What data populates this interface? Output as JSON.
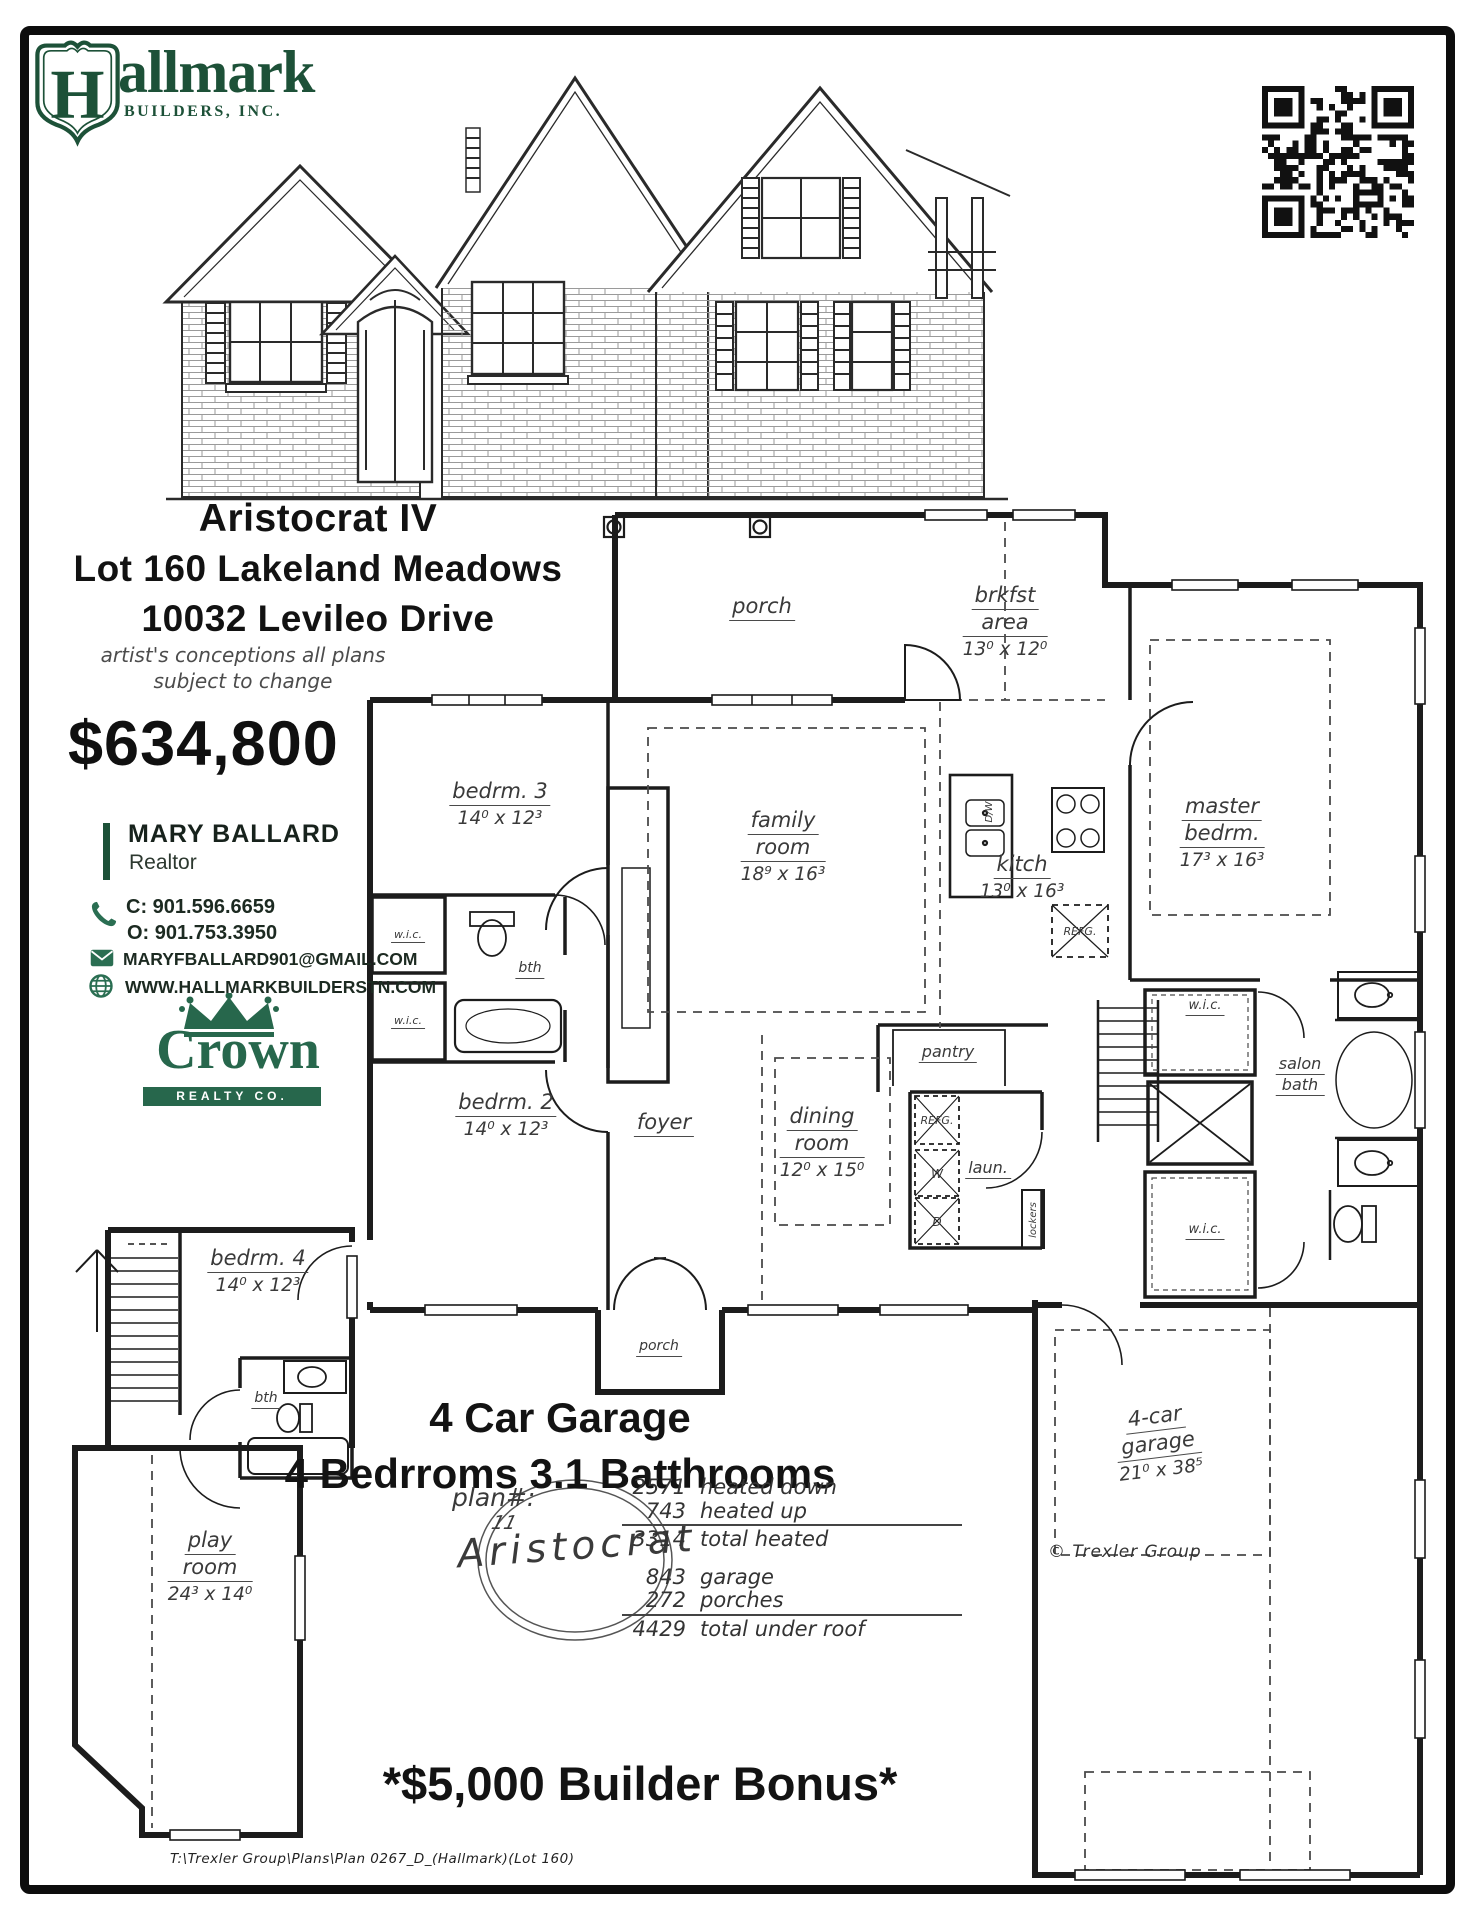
{
  "brand": {
    "hallmark_h": "H",
    "hallmark_rest": "allmark",
    "hallmark_sub": "BUILDERS, INC.",
    "crown_name": "Crown",
    "crown_sub": "REALTY CO.",
    "accent_green": "#1d5138",
    "crown_green": "#27674c"
  },
  "header": {
    "plan_name": "Aristocrat IV",
    "lot_line": "Lot 160 Lakeland Meadows",
    "address_line": "10032 Levileo Drive",
    "disclaimer_line1": "artist's conceptions all plans",
    "disclaimer_line2": "subject to change",
    "price": "$634,800"
  },
  "agent": {
    "name": "MARY BALLARD",
    "title": "Realtor",
    "cell": "C: 901.596.6659",
    "office": "O: 901.753.3950",
    "email": "MARYFBALLARD901@GMAIL.COM",
    "website": "WWW.HALLMARKBUILDERSTN.COM"
  },
  "floorplan": {
    "rooms": {
      "porch_top": {
        "l1": "porch"
      },
      "brkfst": {
        "l1": "brkfst",
        "l2": "area",
        "dims": "13⁰ x 12⁰"
      },
      "bedrm3": {
        "l1": "bedrm. 3",
        "dims": "14⁰ x 12³"
      },
      "family": {
        "l1": "family",
        "l2": "room",
        "dims": "18⁹ x 16³"
      },
      "kitch": {
        "l1": "kitch",
        "dims": "13⁰ x 16³"
      },
      "master": {
        "l1": "master",
        "l2": "bedrm.",
        "dims": "17³ x 16³"
      },
      "bedrm2": {
        "l1": "bedrm. 2",
        "dims": "14⁰ x 12³"
      },
      "foyer": {
        "l1": "foyer"
      },
      "dining": {
        "l1": "dining",
        "l2": "room",
        "dims": "12⁰ x 15⁰"
      },
      "pantry": {
        "l1": "pantry"
      },
      "laun": {
        "l1": "laun."
      },
      "salon_bath": {
        "l1": "salon",
        "l2": "bath"
      },
      "wic": {
        "l1": "w.i.c."
      },
      "bth": {
        "l1": "bth"
      },
      "porch_front": {
        "l1": "porch"
      },
      "bedrm4": {
        "l1": "bedrm. 4",
        "dims": "14⁰ x 12³"
      },
      "play": {
        "l1": "play",
        "l2": "room",
        "dims": "24³ x 14⁰"
      },
      "garage": {
        "l1": "4-car",
        "l2": "garage",
        "dims": "21⁰ x 38⁵"
      }
    },
    "fixtures": {
      "refg": "REFG.",
      "dw": "D/W",
      "washer": "W",
      "dryer": "D",
      "lockers": "lockers"
    },
    "copyright": "© Trexler Group"
  },
  "features": {
    "line1": "4 Car Garage",
    "line2": "4 Bedrroms 3.1 Batthrooms"
  },
  "plan_info": {
    "plan_label": "plan#:",
    "plan_number": "11",
    "plan_name": "Aristocrat",
    "areas": [
      {
        "value": "2571",
        "label": "heated down"
      },
      {
        "value": "743",
        "label": "heated up"
      },
      {
        "value": "3314",
        "label": "total heated"
      },
      {
        "value": "843",
        "label": "garage"
      },
      {
        "value": "272",
        "label": "porches"
      },
      {
        "value": "4429",
        "label": "total under roof"
      }
    ]
  },
  "bonus": "*$5,000 Builder Bonus*",
  "footer": "T:\\Trexler  Group\\Plans\\Plan  0267_D_(Hallmark)(Lot  160)"
}
